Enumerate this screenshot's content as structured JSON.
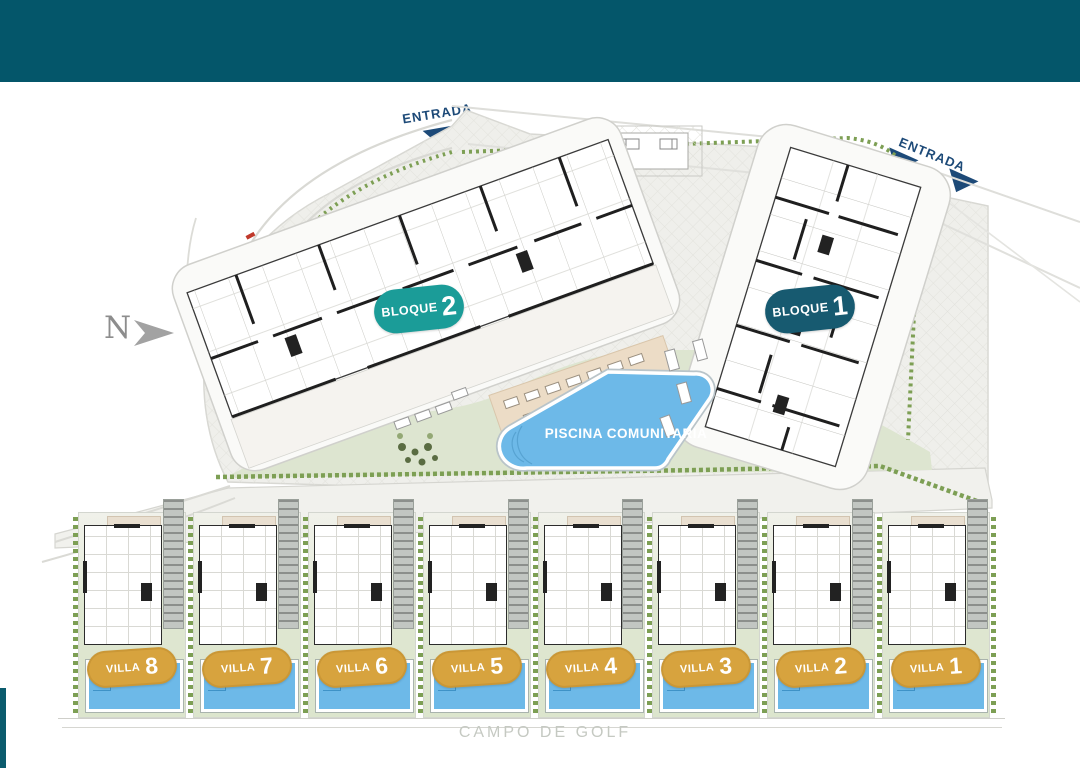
{
  "header": {
    "color": "#04566a"
  },
  "north_label": "N",
  "entrance_top": "ENTRADA",
  "entrance_right": "ENTRADA",
  "blocks": [
    {
      "label": "BLOQUE",
      "number": "2",
      "badge_color": "#1b9c98"
    },
    {
      "label": "BLOQUE",
      "number": "1",
      "badge_color": "#175a70"
    }
  ],
  "pool_label": "PISCINA COMUNITARIA",
  "villas": [
    {
      "label": "VILLA",
      "number": "8"
    },
    {
      "label": "VILLA",
      "number": "7"
    },
    {
      "label": "VILLA",
      "number": "6"
    },
    {
      "label": "VILLA",
      "number": "5"
    },
    {
      "label": "VILLA",
      "number": "4"
    },
    {
      "label": "VILLA",
      "number": "3"
    },
    {
      "label": "VILLA",
      "number": "2"
    },
    {
      "label": "VILLA",
      "number": "1"
    }
  ],
  "golf_label": "CAMPO DE GOLF",
  "colors": {
    "header_bar": "#04566a",
    "villa_badge": "#d7a33e",
    "pool_blue": "#6db9e8",
    "entrance_navy": "#1d4a78",
    "hedge_green": "#7d9f54",
    "grass": "#dfe7d2",
    "paving": "#efefeb"
  }
}
